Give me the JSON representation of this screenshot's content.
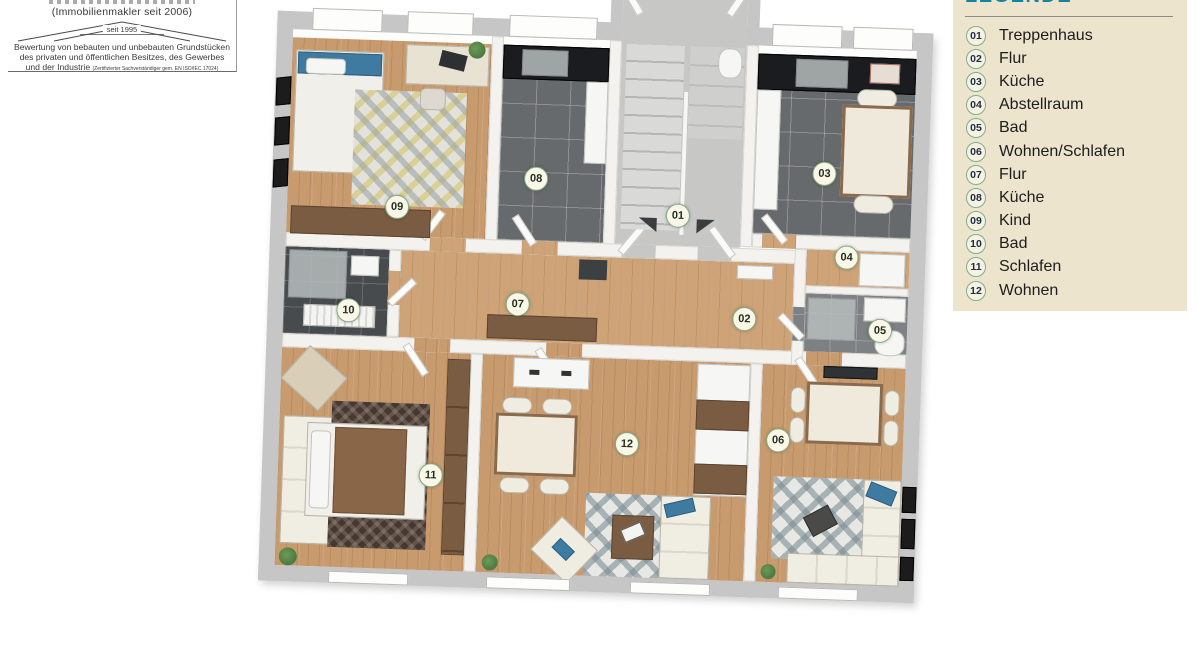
{
  "logo": {
    "line1": "(Immobilienmakler seit 2006)",
    "roof_label": "seit 1995",
    "line2": "Bewertung von bebauten und unbebauten Grundstücken",
    "line3": "des privaten und öffentlichen Besitzes, des Gewerbes",
    "line4": "und der Industrie",
    "certification": "(Zertifizierter Sachverständiger gem. EN ISO/IEC 17024)"
  },
  "legend": {
    "title": "LEGENDE",
    "items": [
      {
        "num": "01",
        "label": "Treppenhaus"
      },
      {
        "num": "02",
        "label": "Flur"
      },
      {
        "num": "03",
        "label": "Küche"
      },
      {
        "num": "04",
        "label": "Abstellraum"
      },
      {
        "num": "05",
        "label": "Bad"
      },
      {
        "num": "06",
        "label": "Wohnen/Schlafen"
      },
      {
        "num": "07",
        "label": "Flur"
      },
      {
        "num": "08",
        "label": "Küche"
      },
      {
        "num": "09",
        "label": "Kind"
      },
      {
        "num": "10",
        "label": "Bad"
      },
      {
        "num": "11",
        "label": "Schlafen"
      },
      {
        "num": "12",
        "label": "Wohnen"
      }
    ],
    "colors": {
      "panel_bg": "#ece4cd",
      "title": "#1783a0",
      "badge_border": "#7fae8f",
      "badge_text": "#1d2b47",
      "label_text": "#1d1d1d"
    }
  },
  "plan": {
    "type": "3d-floorplan-render",
    "badges": [
      {
        "num": "01",
        "x": 426,
        "y": 264
      },
      {
        "num": "02",
        "x": 496,
        "y": 365
      },
      {
        "num": "03",
        "x": 571,
        "y": 217
      },
      {
        "num": "04",
        "x": 596,
        "y": 300
      },
      {
        "num": "05",
        "x": 632,
        "y": 372
      },
      {
        "num": "06",
        "x": 534,
        "y": 485
      },
      {
        "num": "07",
        "x": 269,
        "y": 358
      },
      {
        "num": "08",
        "x": 283,
        "y": 232
      },
      {
        "num": "09",
        "x": 145,
        "y": 265
      },
      {
        "num": "10",
        "x": 100,
        "y": 370
      },
      {
        "num": "11",
        "x": 188,
        "y": 532
      },
      {
        "num": "12",
        "x": 383,
        "y": 494
      }
    ],
    "colors": {
      "wood": "#c89b6f",
      "kitchen_tile": "#676a6c",
      "counter": "#1a1c20",
      "walls_outer": "#c6c6c6",
      "walls_inner": "#f3f2ef",
      "rug_accent_blue": "#3f7ba0"
    }
  }
}
